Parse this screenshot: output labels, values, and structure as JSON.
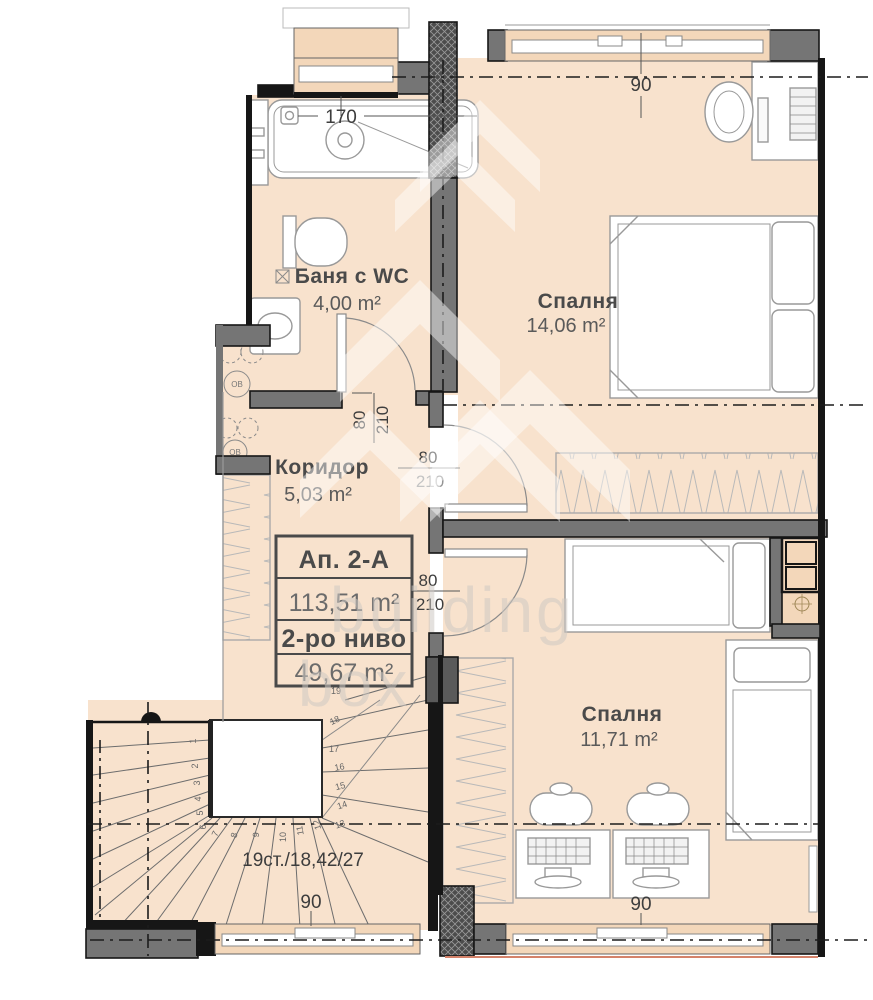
{
  "rooms": {
    "bathroom": {
      "name": "Баня с WC",
      "area": "4,00 m²"
    },
    "bedroom_top": {
      "name": "Спалня",
      "area": "14,06 m²"
    },
    "corridor": {
      "name": "Коридор",
      "area": "5,03 m²"
    },
    "bedroom_bottom": {
      "name": "Спалня",
      "area": "11,71 m²"
    }
  },
  "info_box": {
    "apartment": "Ап. 2-А",
    "total_area": "113,51 m²",
    "level": "2-ро ниво",
    "level_area": "49,67 m²"
  },
  "stairs": {
    "label": "19ст./18,42/27",
    "steps": [
      "1",
      "2",
      "3",
      "4",
      "5",
      "6",
      "7",
      "8",
      "9",
      "10",
      "11",
      "12",
      "13",
      "14",
      "15",
      "16",
      "17",
      "18",
      "19"
    ]
  },
  "dimensions": {
    "bath_window_width": "170",
    "window_top": "90",
    "window_bottom": "90",
    "window_stairs": "90",
    "doors": [
      {
        "width": "80",
        "height": "210"
      },
      {
        "width": "80",
        "height": "210"
      },
      {
        "width": "80",
        "height": "210"
      }
    ]
  },
  "shaft": {
    "label": "ОВ"
  },
  "watermark": {
    "line1": "building",
    "line2": "box"
  },
  "colors": {
    "floor": "#f8e2cd",
    "sill": "#f3d7ba",
    "wall": "#757575",
    "wall_dark": "#161616",
    "furniture_stroke": "#999999",
    "accent_red": "#d4826a"
  }
}
